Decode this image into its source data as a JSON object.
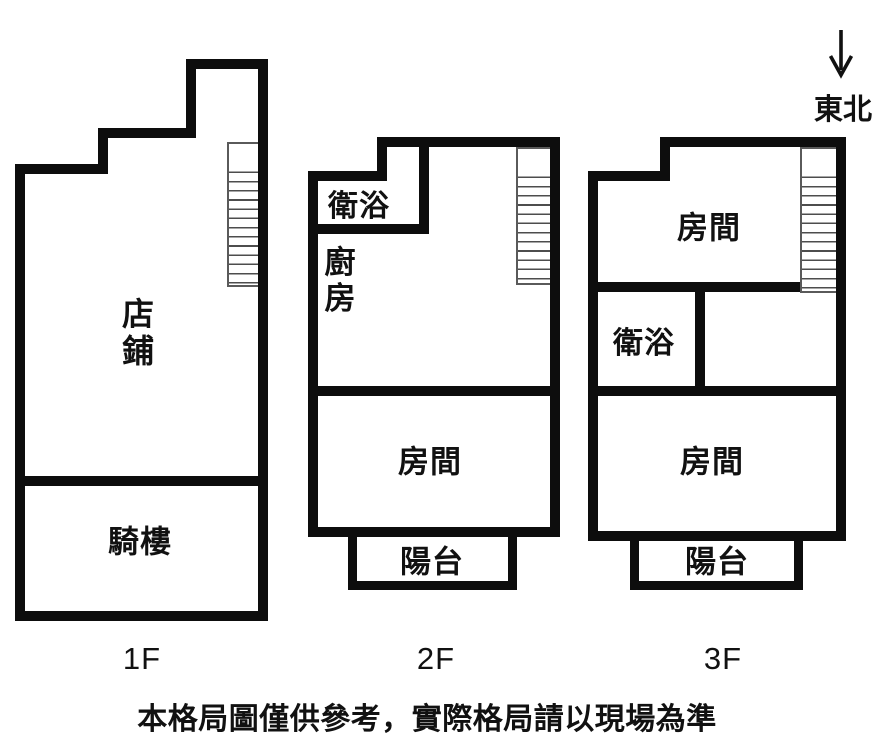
{
  "title": "floor-plan",
  "compass": {
    "label": "東北",
    "arrow_icon": "down-arrow"
  },
  "floors": [
    {
      "label": "1F",
      "rooms": [
        {
          "name": "店鋪",
          "orientation": "vertical"
        },
        {
          "name": "騎樓",
          "orientation": "horizontal"
        }
      ],
      "has_stairs": true
    },
    {
      "label": "2F",
      "rooms": [
        {
          "name": "衛浴",
          "orientation": "horizontal"
        },
        {
          "name": "廚房",
          "orientation": "vertical"
        },
        {
          "name": "房間",
          "orientation": "horizontal"
        },
        {
          "name": "陽台",
          "orientation": "horizontal"
        }
      ],
      "has_stairs": true
    },
    {
      "label": "3F",
      "rooms": [
        {
          "name": "房間",
          "orientation": "horizontal"
        },
        {
          "name": "衛浴",
          "orientation": "horizontal"
        },
        {
          "name": "房間",
          "orientation": "horizontal"
        },
        {
          "name": "陽台",
          "orientation": "horizontal"
        }
      ],
      "has_stairs": true
    }
  ],
  "disclaimer": "本格局圖僅供參考，實際格局請以現場為準",
  "colors": {
    "wall": "#0d0d0d",
    "background": "#ffffff",
    "stair_line": "#4d4d4d",
    "text": "#111111"
  }
}
